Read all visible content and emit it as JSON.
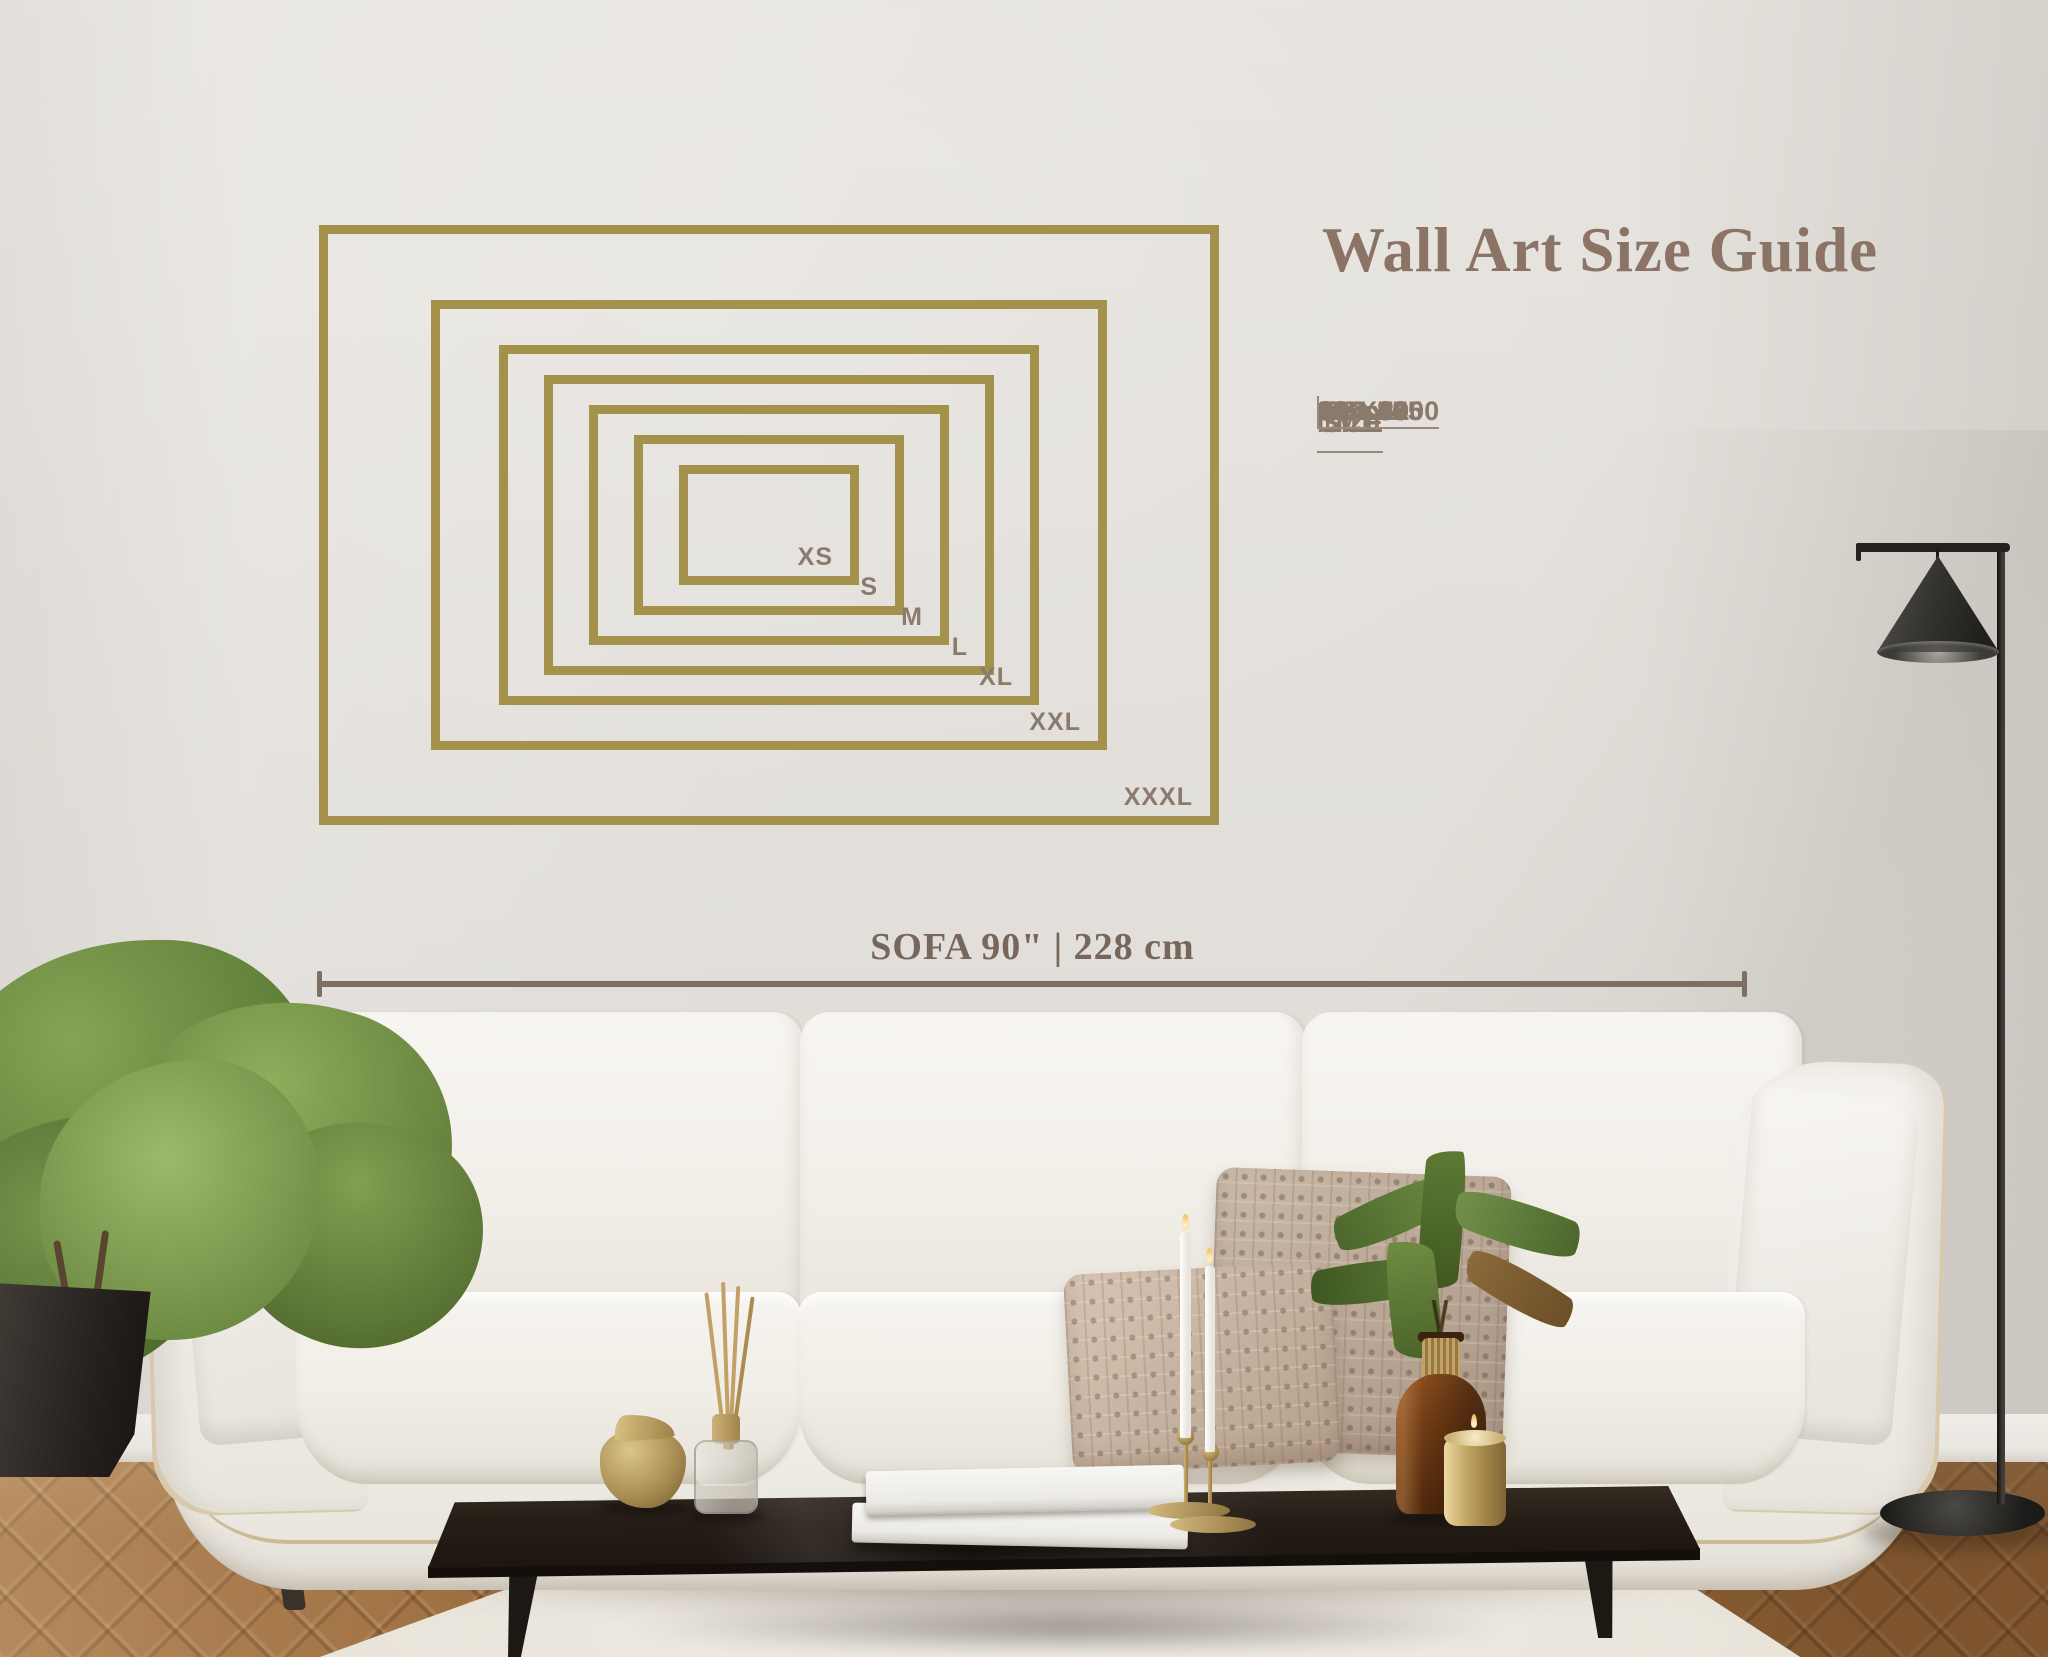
{
  "title": "Wall Art Size Guide",
  "size_table": {
    "headers": [
      "SIZE",
      "INCH",
      "CM"
    ],
    "rows": [
      {
        "size": "XS",
        "inch": "12 x 8",
        "cm": "30 x 20"
      },
      {
        "size": "S",
        "inch": "18 x 12",
        "cm": "46 x 30"
      },
      {
        "size": "M",
        "inch": "24 x 16",
        "cm": "60 x 40"
      },
      {
        "size": "L",
        "inch": "30 x 20",
        "cm": "76 x 51"
      },
      {
        "size": "XL",
        "inch": "36 x 24",
        "cm": "91 x 61"
      },
      {
        "size": "XXL",
        "inch": "45 x 30",
        "cm": "115 x 75"
      },
      {
        "size": "XXXL",
        "inch": "60 x 40",
        "cm": "150 x 100"
      }
    ]
  },
  "diagram": {
    "labels": [
      "XS",
      "S",
      "M",
      "L",
      "XL",
      "XXL",
      "XXXL"
    ]
  },
  "sofa_measure": {
    "label": "SOFA 90\" | 228 cm"
  },
  "colors": {
    "frame_gold": "#a3914c",
    "text_brown": "#8a7a6b",
    "title_brown": "#8b7466",
    "measure_brown": "#77675a"
  }
}
